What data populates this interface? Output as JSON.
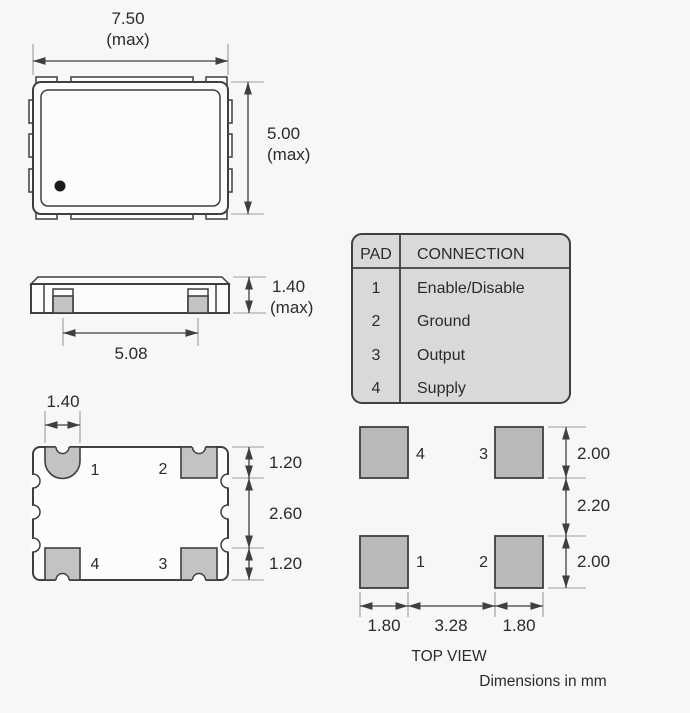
{
  "drawing": {
    "caption_view": "TOP VIEW",
    "caption_units": "Dimensions in mm"
  },
  "pad_table": {
    "header": {
      "pad": "PAD",
      "connection": "CONNECTION"
    },
    "rows": [
      {
        "pad": "1",
        "connection": "Enable/Disable"
      },
      {
        "pad": "2",
        "connection": "Ground"
      },
      {
        "pad": "3",
        "connection": "Output"
      },
      {
        "pad": "4",
        "connection": "Supply"
      }
    ]
  },
  "top_view": {
    "width": "7.50",
    "width_qual": "(max)",
    "height": "5.00",
    "height_qual": "(max)"
  },
  "side_view": {
    "height": "1.40",
    "height_qual": "(max)",
    "pad_span": "5.08"
  },
  "bottom_view": {
    "pad_width": "1.40",
    "top_pad_depth": "1.20",
    "center_gap": "2.60",
    "bottom_pad_depth": "1.20",
    "pads": {
      "p1": "1",
      "p2": "2",
      "p3": "3",
      "p4": "4"
    }
  },
  "land_pattern": {
    "pads": {
      "p1": "1",
      "p2": "2",
      "p3": "3",
      "p4": "4"
    },
    "pad_height_top": "2.00",
    "row_gap": "2.20",
    "pad_height_bottom": "2.00",
    "pad_width_left": "1.80",
    "col_gap": "3.28",
    "pad_width_right": "1.80"
  },
  "colors": {
    "background": "#f7f7f7",
    "line": "#3f3f3f",
    "extension_line": "#9c9c9c",
    "pad_fill": "#bdbdbd",
    "table_fill": "#d9d9d9",
    "text": "#2b2b2b"
  }
}
